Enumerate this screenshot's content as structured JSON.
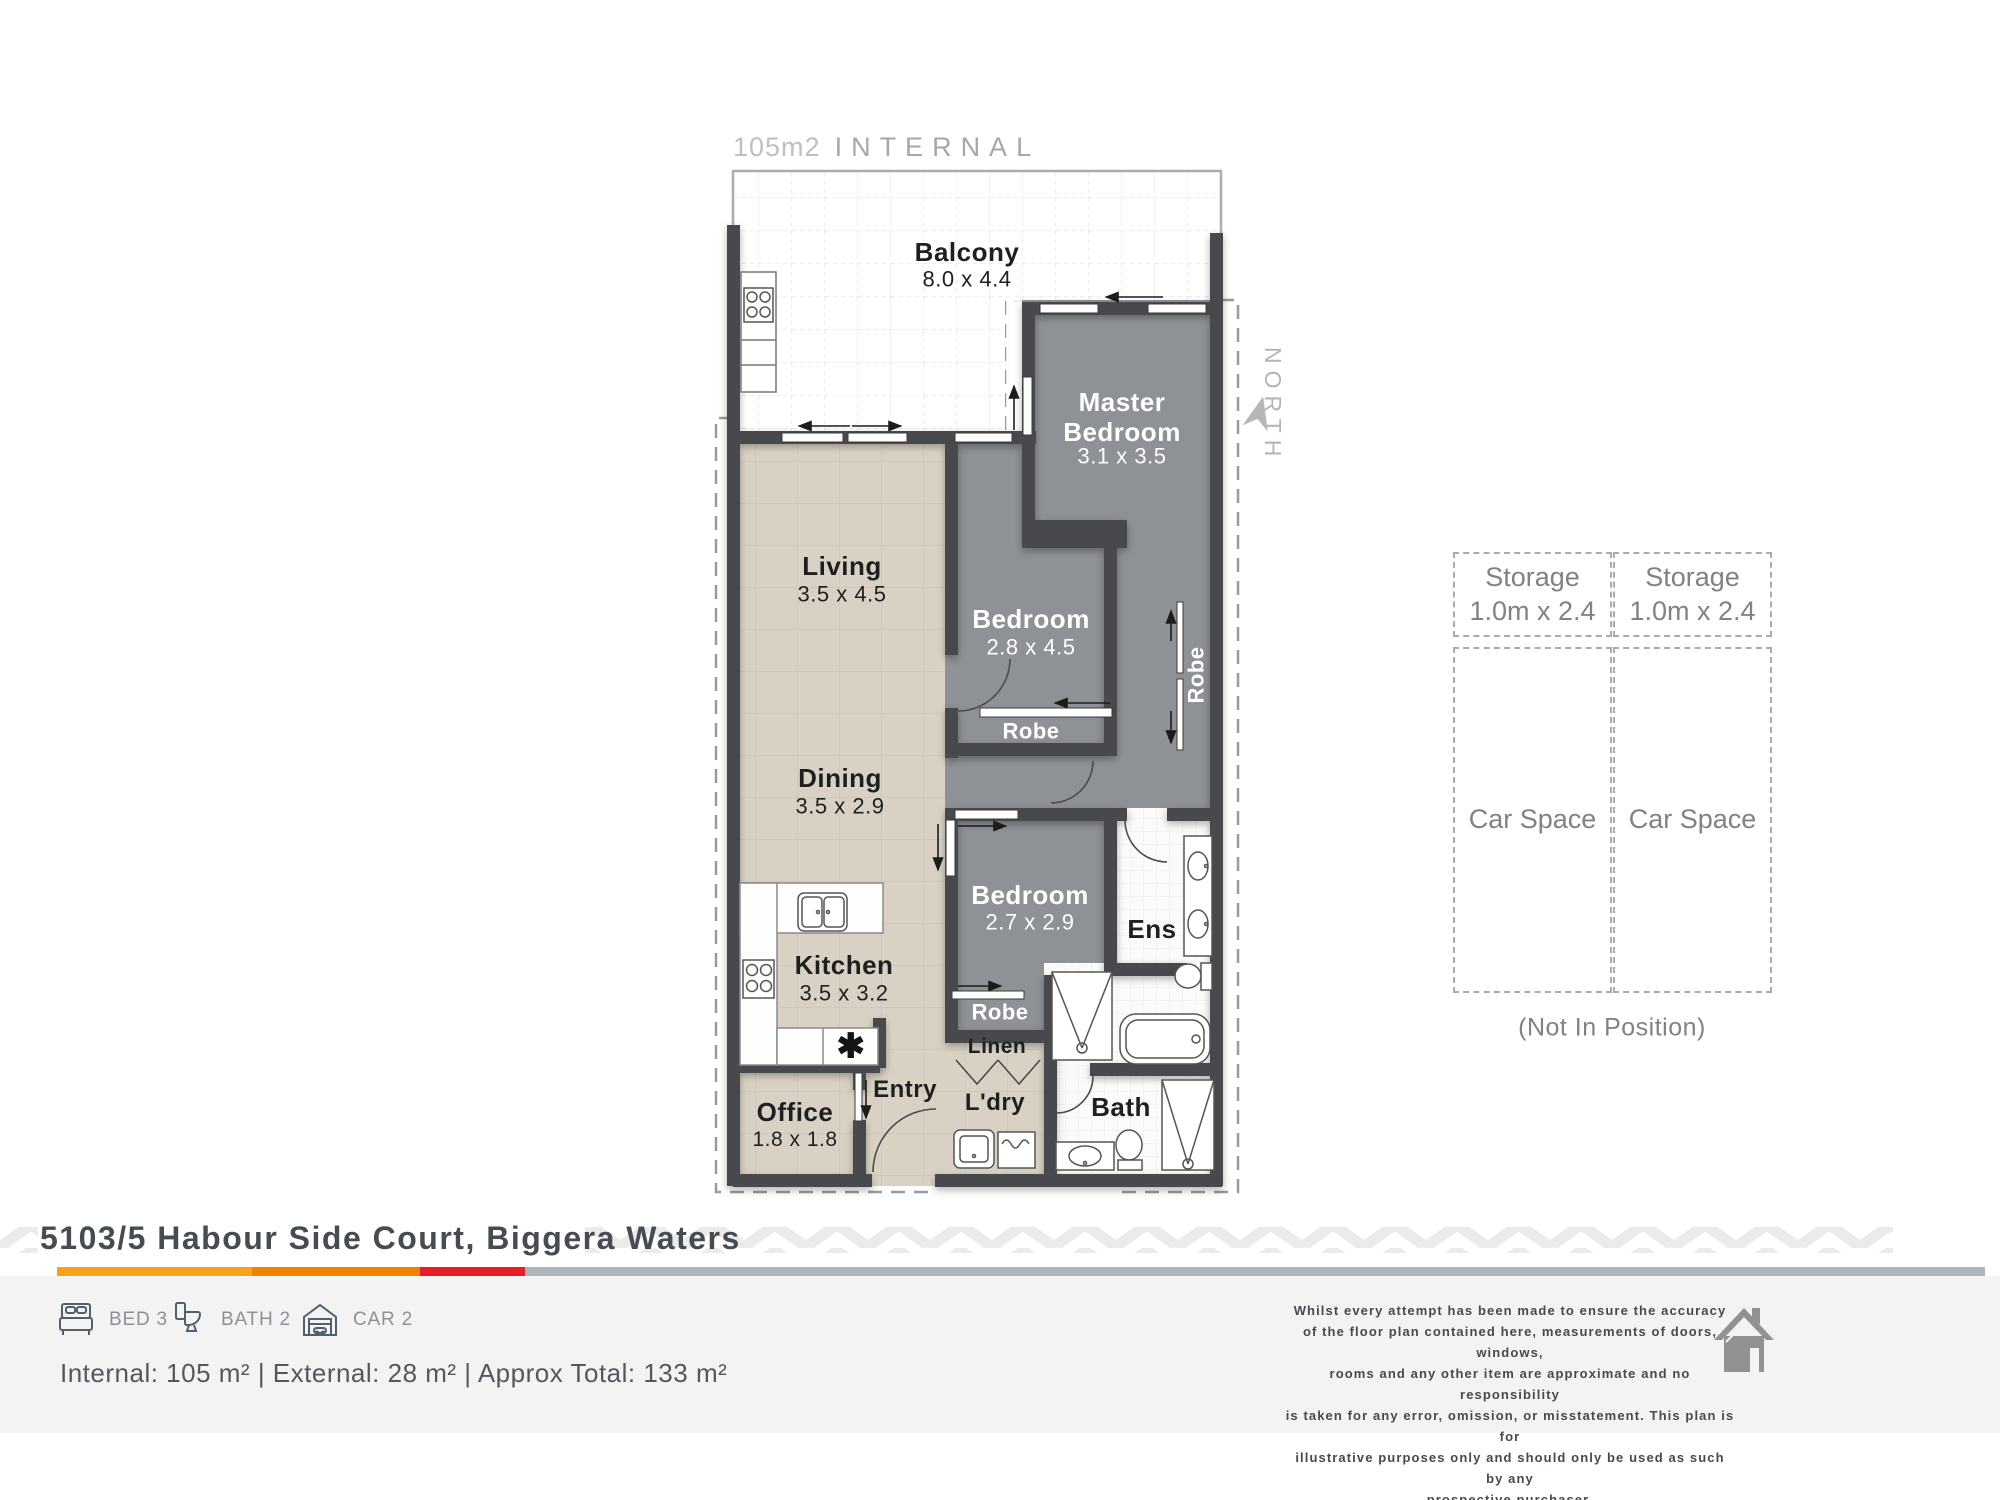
{
  "plan": {
    "annotations": {
      "internal_area": "105m2",
      "internal_word": "INTERNAL",
      "north": "NORTH",
      "dishwasher_symbol": "✱"
    },
    "rooms": {
      "balcony": {
        "name": "Balcony",
        "dims": "8.0 x 4.4"
      },
      "master_bedroom": {
        "name": "Master Bedroom",
        "dims": "3.1 x 3.5"
      },
      "living": {
        "name": "Living",
        "dims": "3.5 x 4.5"
      },
      "bedroom2": {
        "name": "Bedroom",
        "dims": "2.8 x 4.5"
      },
      "dining": {
        "name": "Dining",
        "dims": "3.5 x 2.9"
      },
      "bedroom3": {
        "name": "Bedroom",
        "dims": "2.7 x 2.9"
      },
      "kitchen": {
        "name": "Kitchen",
        "dims": "3.5 x 3.2"
      },
      "office": {
        "name": "Office",
        "dims": "1.8 x 1.8"
      },
      "ensuite": {
        "name": "Ens"
      },
      "entry": {
        "name": "Entry"
      },
      "laundry": {
        "name": "L'dry"
      },
      "bath": {
        "name": "Bath"
      },
      "linen": {
        "name": "Linen"
      },
      "robe_bedroom2": {
        "name": "Robe"
      },
      "robe_master": {
        "name": "Robe"
      },
      "robe_bedroom3": {
        "name": "Robe"
      }
    }
  },
  "parking": {
    "storage1": {
      "name": "Storage",
      "dims": "1.0m x 2.4"
    },
    "storage2": {
      "name": "Storage",
      "dims": "1.0m x 2.4"
    },
    "car1": {
      "name": "Car Space"
    },
    "car2": {
      "name": "Car Space"
    },
    "note": "(Not In Position)"
  },
  "footer": {
    "address": "5103/5 Habour Side Court, Biggera Waters",
    "bed": "BED 3",
    "bath": "BATH 2",
    "car": "CAR 2",
    "areas": "Internal: 105 m² | External: 28 m² | Approx Total: 133 m²",
    "disclaimer": [
      "Whilst every attempt has been made to ensure the accuracy",
      "of the floor plan contained here, measurements of doors, windows,",
      "rooms and any other item are approximate and no responsibility",
      "is taken for any error, omission, or misstatement. This plan is for",
      "illustrative purposes only and should only be used as such by any",
      "prospective purchaser."
    ]
  },
  "colors": {
    "bar_gold": "#F5A31B",
    "bar_orange": "#EF8200",
    "bar_red": "#E61E28",
    "bar_gray": "#AEB4B7",
    "wall": "#474A4E",
    "bedroom_fill": "#8E9195",
    "floor_beige": "#D9D2C4",
    "accent_text": "#474C52"
  }
}
